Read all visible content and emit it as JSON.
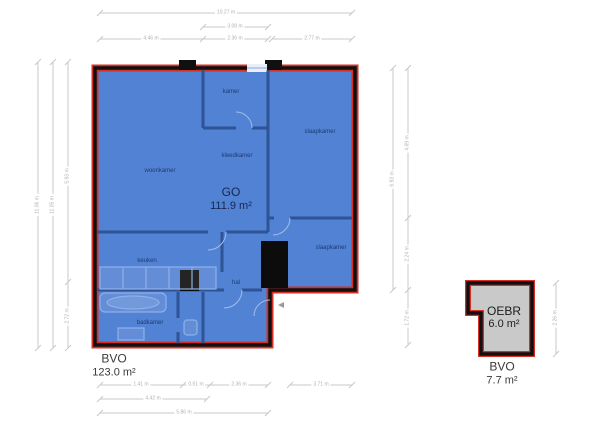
{
  "colors": {
    "plan_fill": "#5282d3",
    "plan_outline_red": "#d43026",
    "wall_black": "#101010",
    "interior_wall_blue": "#2e5496",
    "annex_fill": "#c9c9c9",
    "dimension_gray": "#c9c9c9",
    "room_text": "#1d3a73"
  },
  "main_plan": {
    "go_label": "GO",
    "go_area": "111.9 m²",
    "bvo_label": "BVO",
    "bvo_area": "123.0 m²",
    "rooms": [
      {
        "name": "woonkamer"
      },
      {
        "name": "kamer"
      },
      {
        "name": "kleedkamer"
      },
      {
        "name": "slaapkamer"
      },
      {
        "name": "slaapkamer"
      },
      {
        "name": "keuken"
      },
      {
        "name": "hal"
      },
      {
        "name": "badkamer"
      }
    ]
  },
  "annex_plan": {
    "name_label": "OEBR",
    "area": "6.0 m²",
    "bvo_label": "BVO",
    "bvo_area": "7.7 m²"
  },
  "dims": {
    "top_total": "10.27 m",
    "top_mid": "3.08 m",
    "top_a": "4.46 m",
    "top_b": "2.36 m",
    "top_c": "2.77 m",
    "left_outer": "11.06 m",
    "left_mid": "11.05 m",
    "left_upper": "5.93 m",
    "left_lower": "2.72 m",
    "right_outer": "6.93 m",
    "right_upper": "4.69 m",
    "right_mid": "2.24 m",
    "right_lower": "1.72 m",
    "bottom_a": "1.41 m",
    "bottom_b": "0.51 m",
    "bottom_c": "2.36 m",
    "bottom_d": "3.71 m",
    "bottom_e": "4.42 m",
    "bottom_f": "5.86 m",
    "annex_right": "2.26 m"
  }
}
